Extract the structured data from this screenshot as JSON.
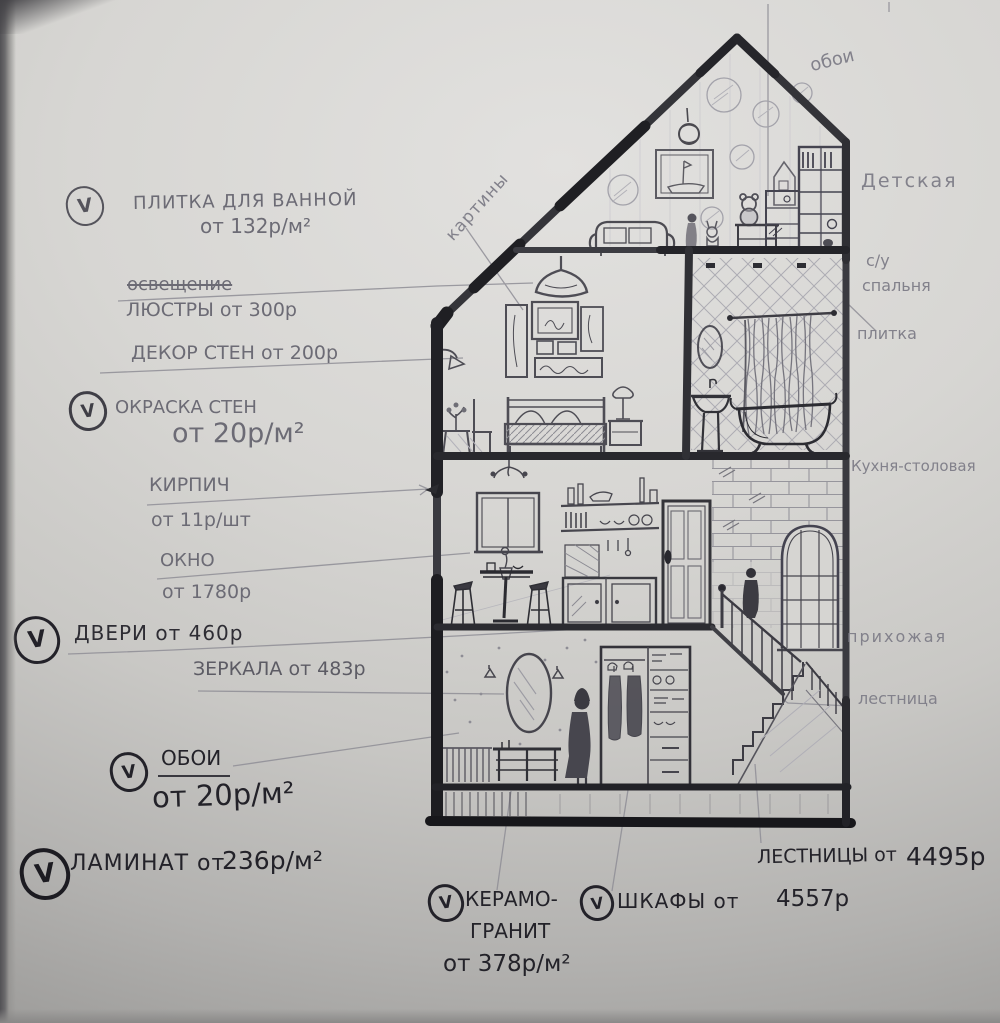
{
  "notes": {
    "tile_bath": {
      "check": "V",
      "line1": "ПЛИТКА ДЛЯ ВАННОЙ",
      "line2": "от 132р/м²"
    },
    "lighting": {
      "struck": "освещение",
      "line1": "ЛЮСТРЫ от 300р"
    },
    "wall_decor": {
      "line1": "ДЕКОР СТЕН от 200р"
    },
    "wall_paint": {
      "check": "V",
      "line1": "ОКРАСКА СТЕН",
      "line2": "от 20р/м²"
    },
    "brick": {
      "line1": "КИРПИЧ",
      "line2": "от 11р/шт"
    },
    "window": {
      "line1": "ОКНО",
      "line2": "от 1780р"
    },
    "doors": {
      "check": "V",
      "line1": "ДВЕРИ от 460р"
    },
    "mirrors": {
      "line1": "ЗЕРКАЛА от 483р"
    },
    "wallpaper": {
      "check": "V",
      "line1": "ОБОИ",
      "line2": "от 20р/м²"
    },
    "laminate": {
      "check": "V",
      "line1": "ЛАМИНАТ от",
      "line2": "236р/м²"
    },
    "ceramic": {
      "check": "V",
      "line1": "КЕРАМО-",
      "line2": "ГРАНИТ",
      "line3": "от 378р/м²"
    },
    "wardrobes": {
      "check": "V",
      "line1": "ШКАФЫ от",
      "line2": "4557р"
    },
    "stairs": {
      "line1": "ЛЕСТНИЦЫ от",
      "line2": "4495р"
    }
  },
  "rooms": {
    "wallpaper_attic": "обои",
    "nursery": "Детская",
    "wc": "с/у",
    "bedroom": "спальня",
    "tile": "плитка",
    "kitchen_dining": "Кухня-столовая",
    "hallway": "прихожая",
    "staircase": "лестница",
    "paintings": "картины"
  },
  "colors": {
    "pencil": "#6c6b75",
    "ink": "#232229",
    "paper_light": "#e2e1df",
    "paper_dark": "#9b9a98"
  }
}
